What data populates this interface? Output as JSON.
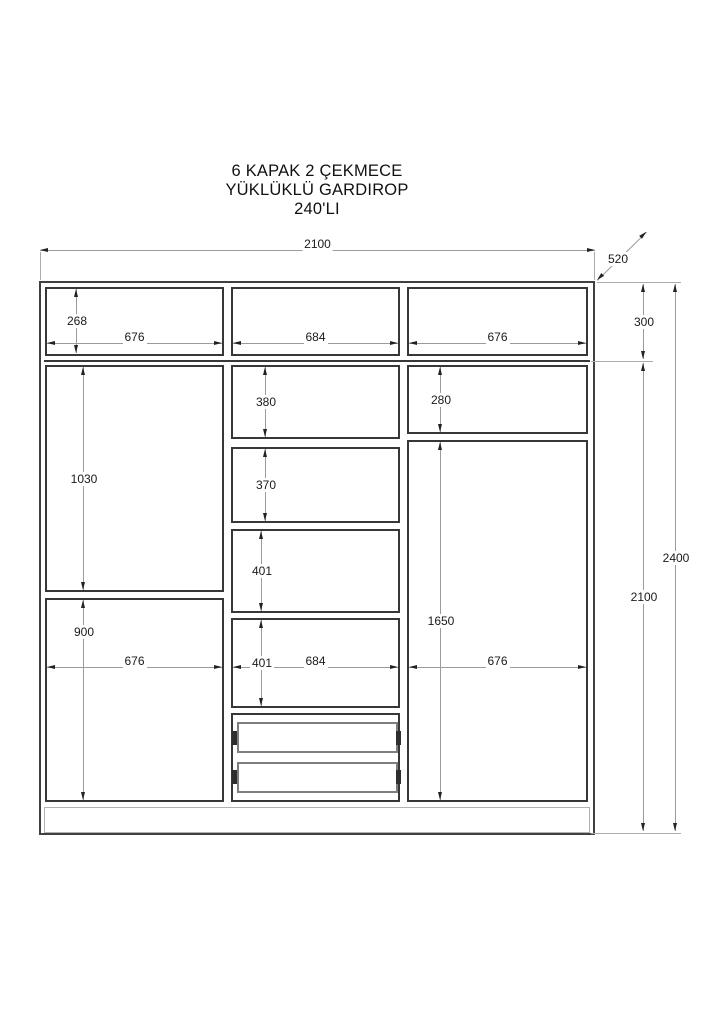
{
  "title": {
    "line1": "6 KAPAK 2 ÇEKMECE",
    "line2": "YÜKLÜKLÜ GARDIROP",
    "line3": "240'LI"
  },
  "dims": {
    "total_width": "2100",
    "depth": "520",
    "top_height": "300",
    "body_height": "2100",
    "total_height": "2400",
    "top_left_door_height": "268",
    "top_left_door_width": "676",
    "top_center_door_width": "684",
    "top_right_door_width": "676",
    "left_upper_door_height": "1030",
    "left_lower_door_height": "900",
    "left_column_width": "676",
    "shelf1_height": "380",
    "shelf2_height": "370",
    "shelf3_height": "401",
    "shelf4_height": "401",
    "middle_column_width": "684",
    "right_top_shelf_height": "280",
    "right_door_height": "1650",
    "right_column_width": "676"
  },
  "colors": {
    "cabinet_line": "#373737",
    "drawer_line": "#7e7e7e",
    "plinth_line": "#b1b1b1",
    "dim_line": "#9b9b9b",
    "text": "#1a1a1a",
    "background": "#ffffff"
  }
}
